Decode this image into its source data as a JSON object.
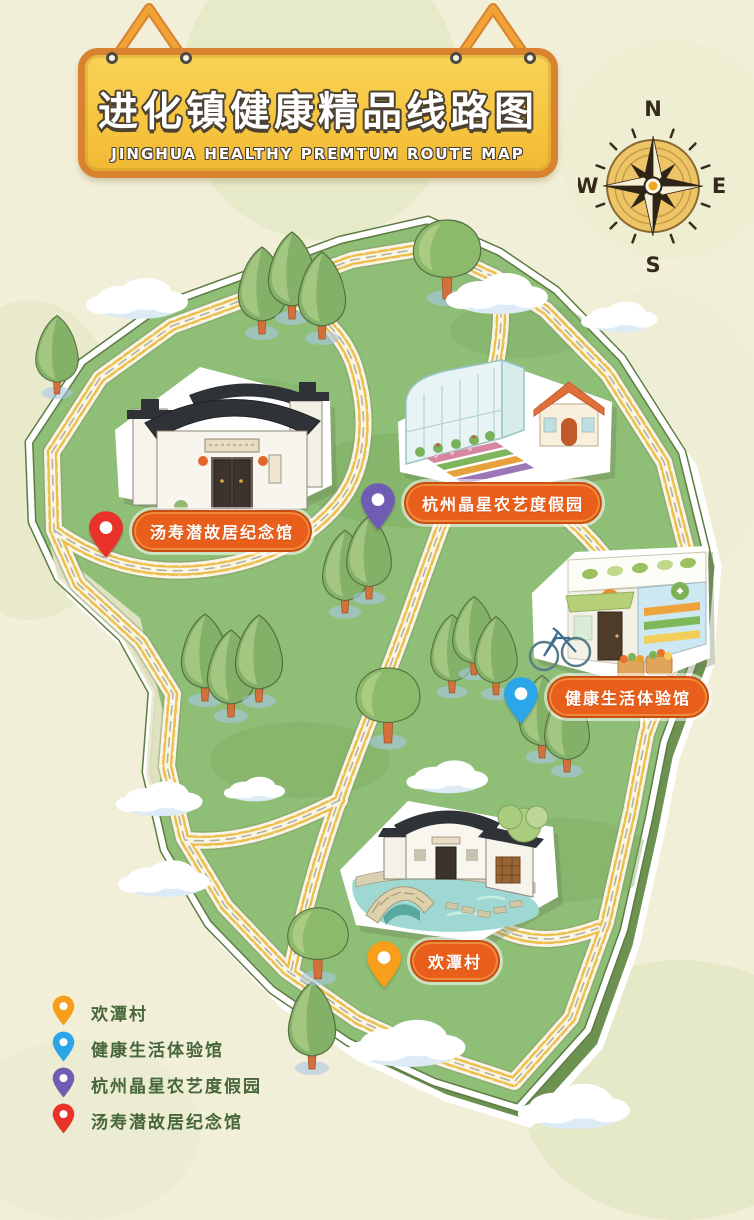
{
  "sign": {
    "title_zh": "进化镇健康精品线路图",
    "title_en": "JINGHUA HEALTHY PREMTUM ROUTE MAP"
  },
  "compass": {
    "north": "N",
    "east": "E",
    "south": "S",
    "west": "W"
  },
  "pois": [
    {
      "name": "汤寿潜故居纪念馆",
      "pin_color": "#e8322a"
    },
    {
      "name": "杭州晶星农艺度假园",
      "pin_color": "#6f5cb5"
    },
    {
      "name": "健康生活体验馆",
      "pin_color": "#2ba6e8"
    },
    {
      "name": "欢潭村",
      "pin_color": "#f79f1b"
    }
  ],
  "legend": {
    "items": [
      {
        "label": "欢潭村",
        "pin_color": "#f79f1b"
      },
      {
        "label": "健康生活体验馆",
        "pin_color": "#2ba6e8"
      },
      {
        "label": "杭州晶星农艺度假园",
        "pin_color": "#6f5cb5"
      },
      {
        "label": "汤寿潜故居纪念馆",
        "pin_color": "#e8322a"
      }
    ]
  },
  "colors": {
    "background": "#f2efd8",
    "island_grass": "#8fbe77",
    "island_side": "#6d9150",
    "road_dash_yellow": "#edbe4a",
    "poi_pill_orange": "#e95e1b",
    "sign_gold": "#f5c23c",
    "sign_border": "#d9822f",
    "legend_text_green": "#47663a"
  }
}
